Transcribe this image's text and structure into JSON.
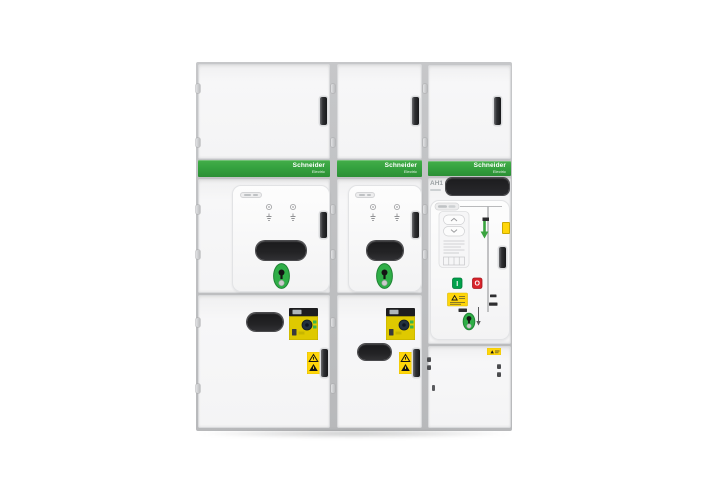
{
  "image": {
    "kind": "product-photo",
    "subject": "Three-cubicle medium-voltage switchgear lineup",
    "background": "#ffffff"
  },
  "brand": {
    "name": "Schneider",
    "tagline": "Electric"
  },
  "labels": {
    "cubicle_designation": "AH1",
    "close_button": "I",
    "open_button": "O"
  },
  "colors": {
    "brand_green": "#35a23f",
    "brand_green_dark": "#2b8f35",
    "cabinet_frame": "#c6c7c9",
    "door_face": "#f4f4f5",
    "door_border": "#d9dadc",
    "handle_dark": "#2e2f32",
    "window_black": "#232325",
    "keyhole_green": "#2fae47",
    "warning_yellow": "#ffd60a",
    "device_yellow": "#dfc900",
    "button_green": "#00a14b",
    "button_red": "#d9232a",
    "mimic_line": "#a4a5a7"
  }
}
